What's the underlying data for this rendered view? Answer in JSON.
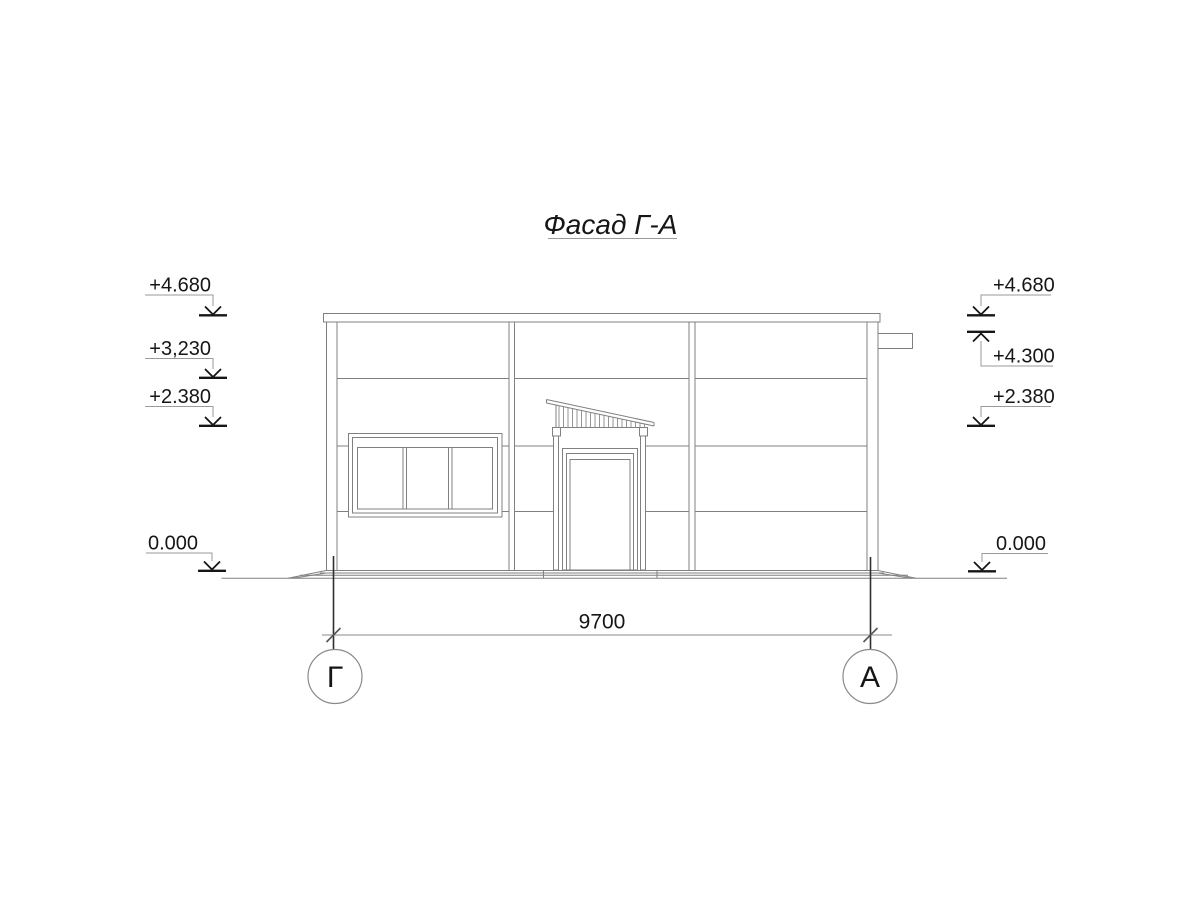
{
  "title": {
    "text": "Фасад Г-А"
  },
  "marks": {
    "left": [
      {
        "value": "+4.680"
      },
      {
        "value": "+3,230"
      },
      {
        "value": "+2.380"
      },
      {
        "value": "0.000"
      }
    ],
    "right": [
      {
        "value": "+4.680"
      },
      {
        "value": "+4.300"
      },
      {
        "value": "+2.380"
      },
      {
        "value": "0.000"
      }
    ]
  },
  "dimension": {
    "value": "9700"
  },
  "axes": [
    {
      "label": "Г"
    },
    {
      "label": "А"
    }
  ],
  "colors": {
    "ink": "#161616",
    "line": "#808080",
    "leader": "#9a9a9a",
    "background": "#ffffff"
  }
}
